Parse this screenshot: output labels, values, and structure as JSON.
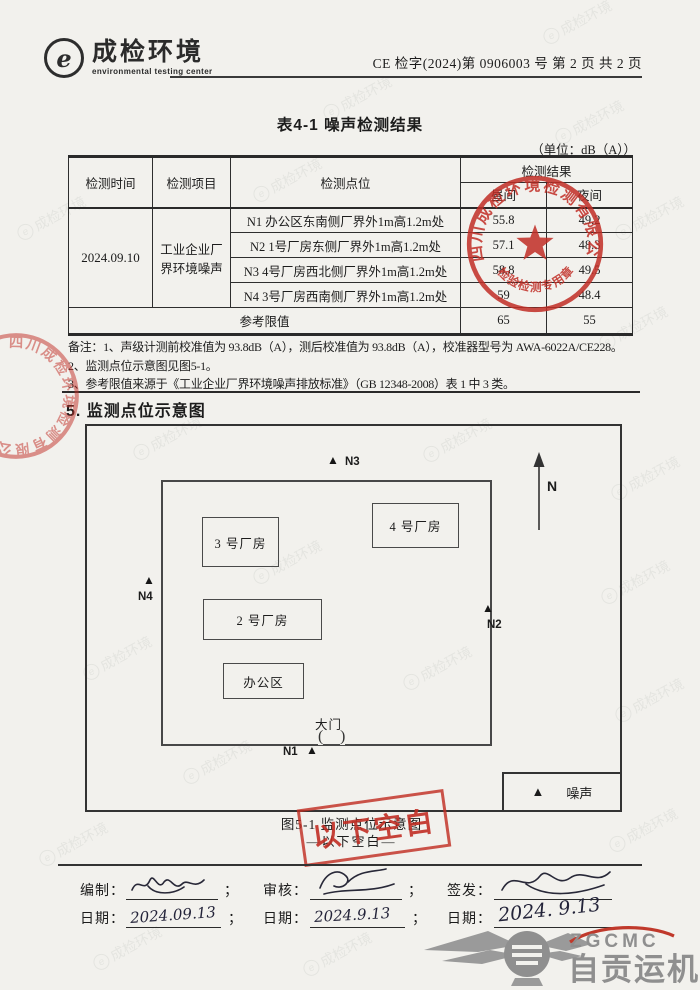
{
  "header": {
    "logo_glyph": "e",
    "logo_text": "成检环境",
    "logo_subtext": "environmental testing center",
    "doc_number": "CE 检字(2024)第 0906003 号  第 2 页 共 2 页"
  },
  "table": {
    "title": "表4-1 噪声检测结果",
    "unit_note": "（单位：dB（A））",
    "col_time": "检测时间",
    "col_item": "检测项目",
    "col_point": "检测点位",
    "col_result": "检测结果",
    "col_day": "昼间",
    "col_night": "夜间",
    "time": "2024.09.10",
    "item": "工业企业厂界环境噪声",
    "rows": [
      {
        "point": "N1 办公区东南侧厂界外1m高1.2m处",
        "day": "55.8",
        "night": "49.2"
      },
      {
        "point": "N2 1号厂房东侧厂界外1m高1.2m处",
        "day": "57.1",
        "night": "48.3"
      },
      {
        "point": "N3 4号厂房西北侧厂界外1m高1.2m处",
        "day": "58.8",
        "night": "49.5"
      },
      {
        "point": "N4 3号厂房西南侧厂界外1m高1.2m处",
        "day": "59",
        "night": "48.4"
      }
    ],
    "limit_label": "参考限值",
    "limit_day": "65",
    "limit_night": "55"
  },
  "notes": {
    "line1": "备注：1、声级计测前校准值为 93.8dB（A），测后校准值为 93.8dB（A），校准器型号为 AWA-6022A/CE228。",
    "line2": "2、监测点位示意图见图5-1。",
    "line3": "3、参考限值来源于《工业企业厂界环境噪声排放标准》（GB 12348-2008）表 1 中 3 类。"
  },
  "section_title": "5. 监测点位示意图",
  "diagram": {
    "north_label": "N",
    "marker_glyph": "▲",
    "buildings": [
      {
        "label": "3 号厂房"
      },
      {
        "label": "4 号厂房"
      },
      {
        "label": "2 号厂房"
      },
      {
        "label": "办公区"
      }
    ],
    "points": [
      {
        "label": "N1"
      },
      {
        "label": "N2"
      },
      {
        "label": "N3"
      },
      {
        "label": "N4"
      }
    ],
    "gate_label": "大门",
    "gate_mark_left": "(",
    "gate_mark_right": ")",
    "legend_label": "噪声",
    "caption": "图5-1 监测点位示意图",
    "blank_note": "—以下空白—"
  },
  "stamps": {
    "seal_ring_text": "四川成检环境检测有限公司",
    "seal_bottom_text": "检验检测专用章",
    "blank_stamp_text": "以下空白",
    "seal_color": "#c12e26"
  },
  "signatures": {
    "compile_label": "编制：",
    "review_label": "审核：",
    "issue_label": "签发：",
    "date_label": "日期：",
    "separator": "；",
    "compile_date": "2024.09.13",
    "review_date": "2024.9.13",
    "issue_date": "2024. 9.13"
  },
  "footer": {
    "logo_abbr": "ZGCMC",
    "logo_name": "自贡运机"
  },
  "watermark": {
    "glyph": "e",
    "text": "成检环境"
  }
}
